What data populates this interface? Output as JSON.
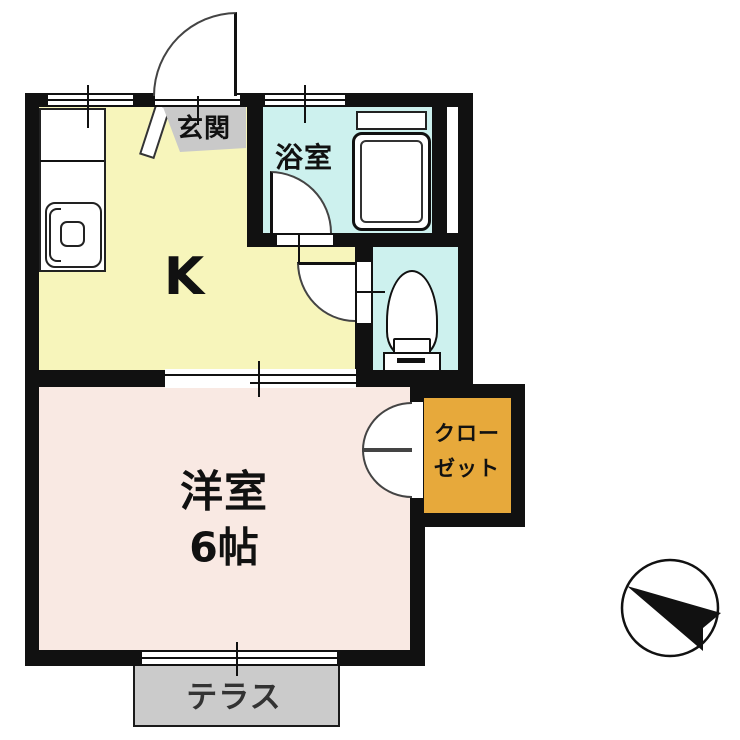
{
  "rooms": {
    "genkan": {
      "label": "玄関"
    },
    "bathroom": {
      "label": "浴室"
    },
    "kitchen": {
      "label": "K"
    },
    "western_room": {
      "label": "洋室",
      "size": "6帖"
    },
    "closet": {
      "label_line1": "クロー",
      "label_line2": "ゼット"
    },
    "terrace": {
      "label": "テラス"
    }
  },
  "icons": {
    "compass": "north-arrow-icon"
  },
  "colors": {
    "wall": "#111111",
    "kitchen-fill": "#f7f5bb",
    "western-fill": "#f9e9e3",
    "wet-fill": "#cdf1ee",
    "closet-fill": "#e7a93b",
    "genkan-fill": "#c9c9c9",
    "terrace-fill": "#cbcbcb"
  }
}
